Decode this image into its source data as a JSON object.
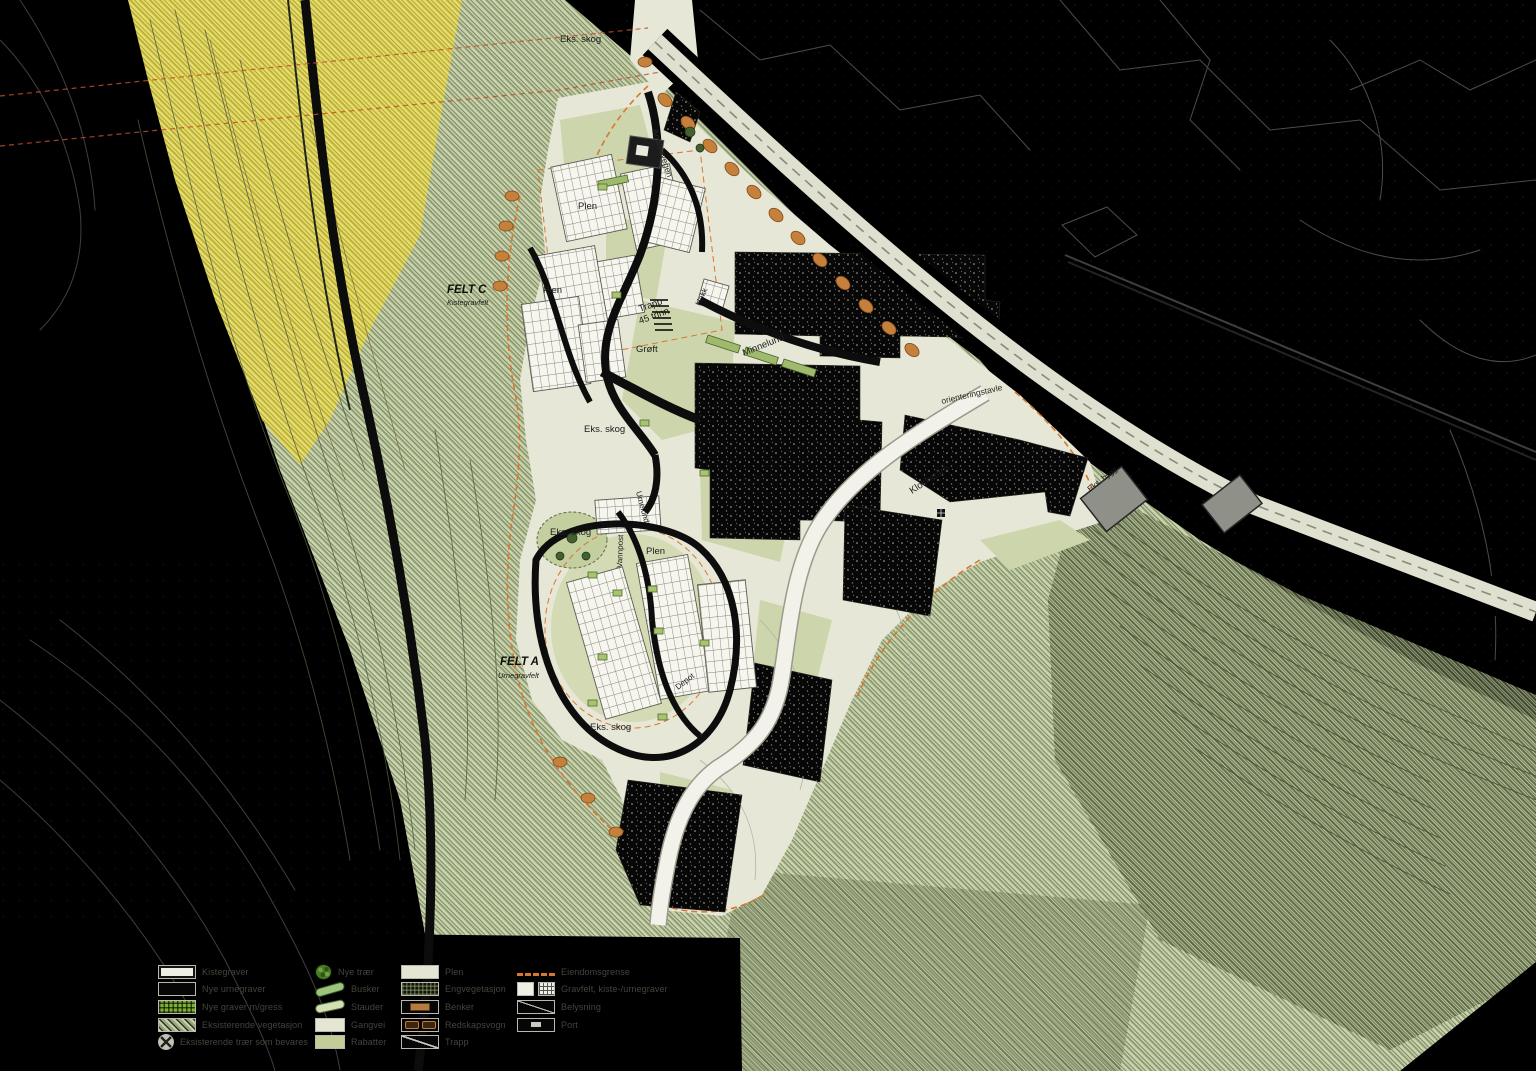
{
  "map_labels": [
    {
      "text": "Eks. skog"
    },
    {
      "text": "FELT C"
    },
    {
      "text": "Kistegravfelt"
    },
    {
      "text": "Plen"
    },
    {
      "text": "Plen"
    },
    {
      "text": "Trapp"
    },
    {
      "text": "45 trinn"
    },
    {
      "text": "Grøft"
    },
    {
      "text": "Hekk"
    },
    {
      "text": "Minnelund"
    },
    {
      "text": "Eks. skog"
    },
    {
      "text": "orienteringstavle"
    },
    {
      "text": "Klokketårn"
    },
    {
      "text": "Eks. skog"
    },
    {
      "text": "Vannpost"
    },
    {
      "text": "Plen"
    },
    {
      "text": "Urnelund"
    },
    {
      "text": "FELT A"
    },
    {
      "text": "Urnegravfelt"
    },
    {
      "text": "Eks. skog"
    },
    {
      "text": "Depot"
    },
    {
      "text": "Eks. bygg"
    },
    {
      "text": "Andresvegen"
    }
  ],
  "legend": {
    "columns": [
      {
        "items": [
          {
            "symbol": "white-rect-swatch",
            "label": "Kistegraver"
          },
          {
            "symbol": "black-rect-swatch",
            "label": "Nye urnegraver"
          },
          {
            "symbol": "green-grid-swatch",
            "label": "Nye graver m/gress"
          },
          {
            "symbol": "hatch-swatch",
            "label": "Eksisterende vegetasjon"
          },
          {
            "symbol": "tree-circle-swatch",
            "label": "Eksisterende trær som bevares"
          }
        ]
      },
      {
        "items": [
          {
            "symbol": "tree-swatch",
            "label": "Nye trær"
          },
          {
            "symbol": "bush-dark-swatch",
            "label": "Busker"
          },
          {
            "symbol": "bush-light-swatch",
            "label": "Stauder"
          },
          {
            "symbol": "beige-rect-swatch",
            "label": "Gangvei"
          },
          {
            "symbol": "green-rect-swatch",
            "label": "Rabatter"
          }
        ]
      },
      {
        "items": [
          {
            "symbol": "beige-rect-swatch",
            "label": "Plen"
          },
          {
            "symbol": "dark-checker-swatch",
            "label": "Engvegetasjon"
          },
          {
            "symbol": "bench-swatch",
            "label": "Benker"
          },
          {
            "symbol": "vogn-swatch",
            "label": "Redskapsvogn"
          },
          {
            "symbol": "stairs-swatch",
            "label": "Trapp"
          }
        ]
      },
      {
        "items": [
          {
            "symbol": "orange-dash-swatch",
            "label": "Eiendomsgrense"
          },
          {
            "symbol": "grave-pair-swatch",
            "label": "Gravfelt, kiste-/urnegraver"
          },
          {
            "symbol": "diag-line-swatch",
            "label": "Belysning"
          },
          {
            "symbol": "port-swatch",
            "label": "Port"
          }
        ]
      }
    ]
  },
  "colors": {
    "background": "#000000",
    "terrain_green": "#cbd5ad",
    "terrain_hatch": "#76845c",
    "field_yellow": "#e7de68",
    "site_beige": "#e6e7d6",
    "plen_green": "#cdd5ad",
    "forest_black": "#070707",
    "road_white": "#f2f2ea",
    "boundary_orange": "#d8772e",
    "powerline_red": "#c1502a",
    "building_gray": "#8f9088",
    "grave_white": "#f6f6ef"
  }
}
